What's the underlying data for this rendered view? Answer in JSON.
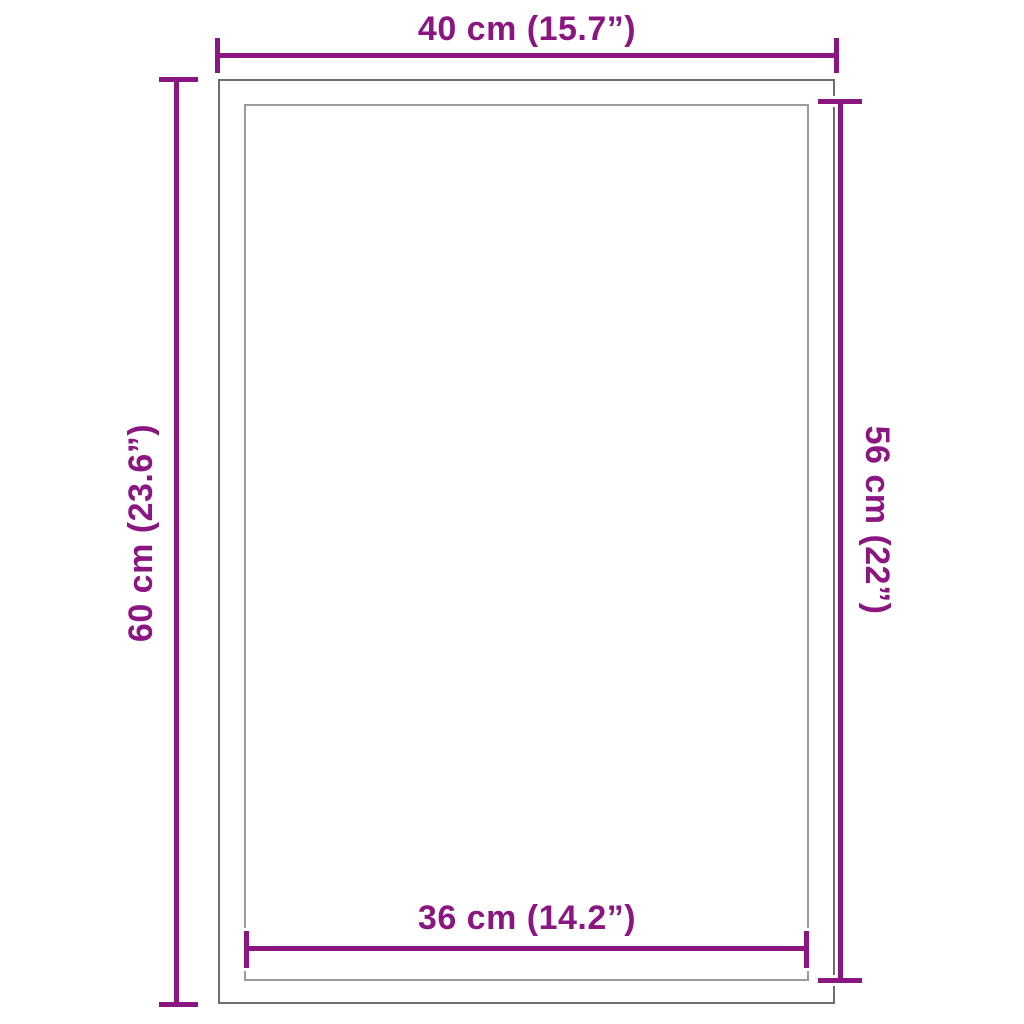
{
  "diagram": {
    "type": "product-dimension-diagram",
    "labels": {
      "top": "40 cm (15.7”)",
      "left": "60 cm (23.6”)",
      "right": "56 cm (22”)",
      "bottom": "36 cm (14.2”)"
    },
    "measurements": {
      "outer_width_cm": 40,
      "outer_width_in": 15.7,
      "outer_height_cm": 60,
      "outer_height_in": 23.6,
      "inner_width_cm": 36,
      "inner_width_in": 14.2,
      "inner_height_cm": 56,
      "inner_height_in": 22
    },
    "colors": {
      "dimension": "#8B1682",
      "outer_rect": "#6E6E6E",
      "inner_rect": "#9A9A9A",
      "background": "#FFFFFF"
    }
  }
}
